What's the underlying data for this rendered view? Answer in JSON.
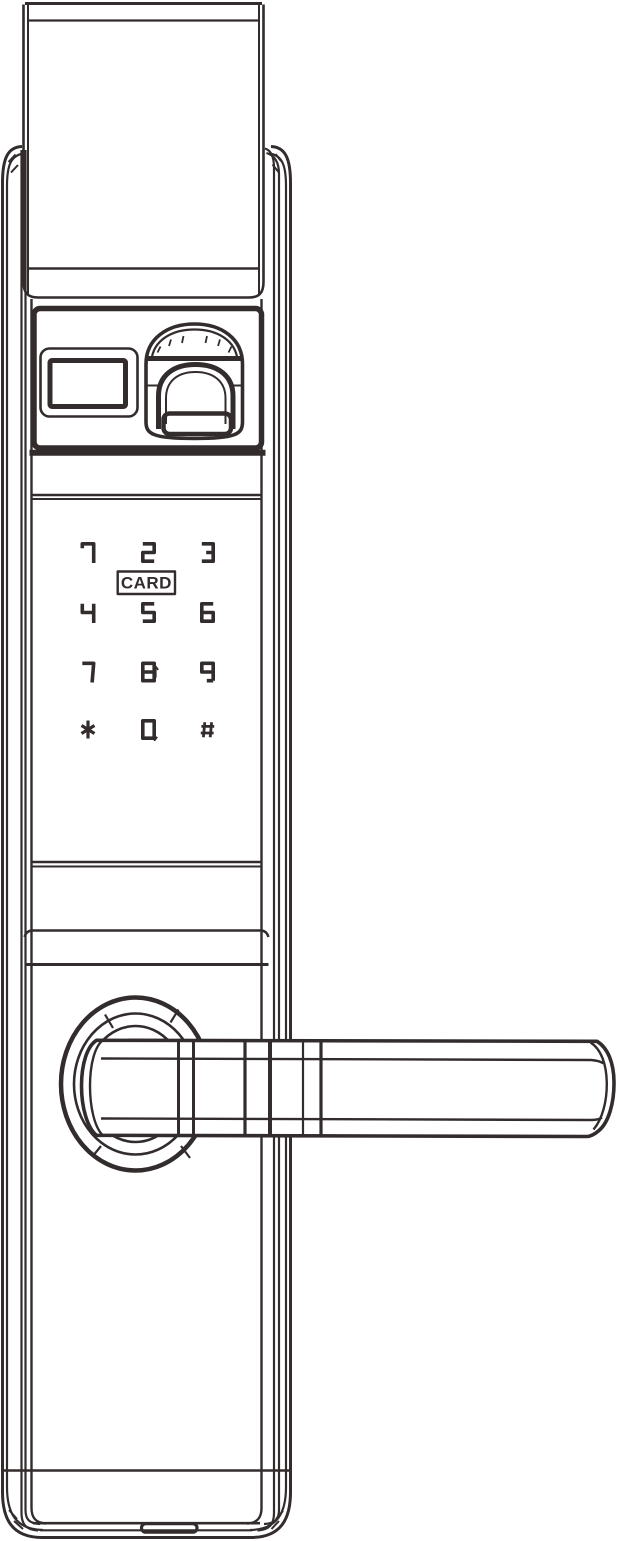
{
  "colors": {
    "line": "#332C2D",
    "background": "#FFFFFF",
    "handle_fill": "#FFFFFF"
  },
  "keypad": {
    "rows": [
      [
        "1",
        "2",
        "3"
      ],
      [
        "4",
        "5",
        "6"
      ],
      [
        "7",
        "8",
        "9"
      ],
      [
        "*",
        "0",
        "#"
      ]
    ],
    "card_label": "CARD",
    "arrows": [
      {
        "key": "8",
        "direction": "up",
        "glyph": "↑"
      },
      {
        "key": "0",
        "direction": "down",
        "glyph": "↓"
      }
    ]
  }
}
